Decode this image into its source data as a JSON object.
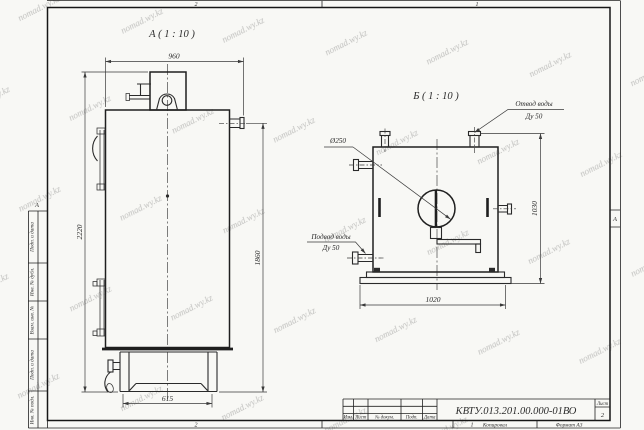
{
  "watermark": "nomad.wy.kz",
  "colors": {
    "line": "#2b2b2b",
    "dim": "#3a3a3a",
    "paper": "#f8f8f5",
    "watermark_color": "#8a93a6"
  },
  "frame": {
    "zone_top_left": "2",
    "zone_top_right": "1",
    "zone_bottom_left": "2",
    "zone_bottom_right": "1",
    "zone_left": "А",
    "zone_right": "А",
    "margin_fields": [
      "Подп. и дата",
      "Инв. № дубл.",
      "Взам. инв. №",
      "Подп. и дата",
      "Инв. № подл."
    ]
  },
  "title_block": {
    "designation": "КВТУ.013.201.00.000-01ВО",
    "sheet_label": "Лист",
    "sheet_number": "2",
    "col_izm": "Изм.",
    "col_list": "Лист",
    "col_docnum": "№ докум.",
    "col_podp": "Подп.",
    "col_data": "Дата",
    "copied_label": "Копировал",
    "format_label": "Формат А3"
  },
  "view_a": {
    "title": "А ( 1 : 10 )",
    "dim_width_top": "960",
    "dim_height_left": "2220",
    "dim_height_right": "1860",
    "dim_base_width": "615"
  },
  "view_b": {
    "title": "Б ( 1 : 10 )",
    "dim_width_bottom": "1020",
    "dim_height_right": "1030",
    "dim_diameter": "Ø250",
    "outlet_label_line1": "Отвод воды",
    "outlet_label_line2": "Ду 50",
    "inlet_label_line1": "Подвод воды",
    "inlet_label_line2": "Ду 50"
  }
}
